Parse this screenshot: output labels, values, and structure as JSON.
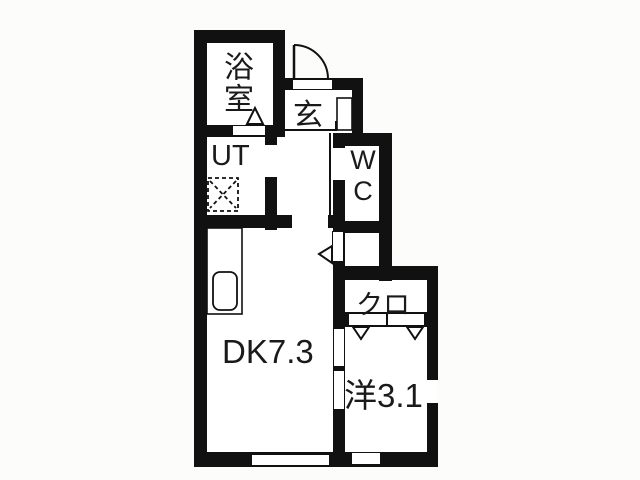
{
  "plan_title": "1DK apartment floor plan",
  "rooms": {
    "bathroom": {
      "label": "浴室"
    },
    "utility": {
      "label": "UT"
    },
    "entrance": {
      "label": "玄"
    },
    "toilet": {
      "label": "WC",
      "line1": "W",
      "line2": "C"
    },
    "closet": {
      "label": "クロ"
    },
    "dining_kitchen": {
      "label": "DK7.3",
      "area_tatami": "7.3"
    },
    "western_room": {
      "label": "洋3.1",
      "area_tatami": "3.1"
    }
  },
  "icons": {
    "entrance_door": "quarter-circle-swing-arc",
    "bath_door_marker": "up-triangle",
    "dk_door_marker": "left-triangle",
    "closet_door_markers": "two-down-triangles",
    "washer_pan": "dashed-square-with-x",
    "kitchen_sink": "rounded-rect"
  },
  "colors": {
    "wall": "#111111",
    "floor": "#ffffff",
    "background": "#fcfcfb",
    "text": "#1a1a1a"
  }
}
